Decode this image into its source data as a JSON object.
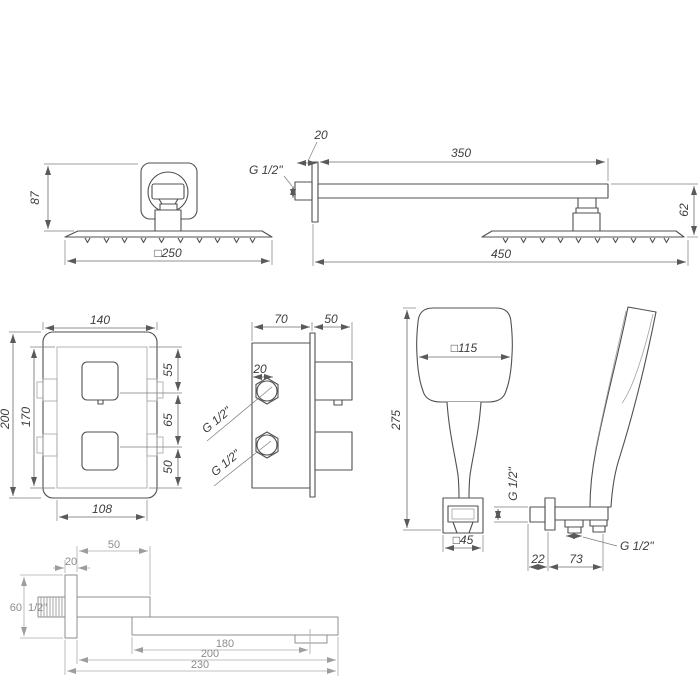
{
  "meta": {
    "title": "Shower system set — technical dimension drawing",
    "background": "#ffffff",
    "line_color": "#505050",
    "light_line_color": "#a3a3a3",
    "spout_line_color": "#8f8f8f",
    "dim_text_color": "#3d3d3d"
  },
  "views": {
    "overhead_shower": {
      "name": "overhead rain shower head — front view",
      "dim_height": "87",
      "dim_width": "□250"
    },
    "shower_arm": {
      "name": "wall shower arm with rain head — side view",
      "thread": "G 1/2\"",
      "dim_plate": "20",
      "dim_arm_length": "350",
      "dim_head_drop": "62",
      "dim_total_reach": "450"
    },
    "mixer_front": {
      "name": "concealed thermostatic mixer — front view",
      "dim_width": "140",
      "dim_height": "200",
      "dim_inner_height": "170",
      "dim_top_segment": "55",
      "dim_mid_segment": "65",
      "dim_bottom_segment": "50",
      "dim_inner_width": "108"
    },
    "mixer_side": {
      "name": "concealed thermostatic mixer — side view",
      "dim_body_depth": "70",
      "dim_knob_depth": "50",
      "dim_port": "20",
      "thread_upper": "G 1/2\"",
      "thread_lower": "G 1/2\""
    },
    "hand_shower": {
      "name": "hand shower — front view",
      "dim_head_width": "□115",
      "dim_length": "275",
      "dim_holder_width": "□45"
    },
    "wall_holder": {
      "name": "hand shower wall holder — side view",
      "thread_wall": "G 1/2\"",
      "thread_outlet": "G 1/2\"",
      "dim_offset": "22",
      "dim_arm": "73"
    },
    "spout": {
      "name": "wall bath spout — side view",
      "dim_upper_reach": "50",
      "dim_plate": "20",
      "dim_plate_height": "60",
      "thread": "1/2\"",
      "dim_outlet_reach": "180",
      "dim_body_length": "200",
      "dim_total_length": "230"
    }
  }
}
